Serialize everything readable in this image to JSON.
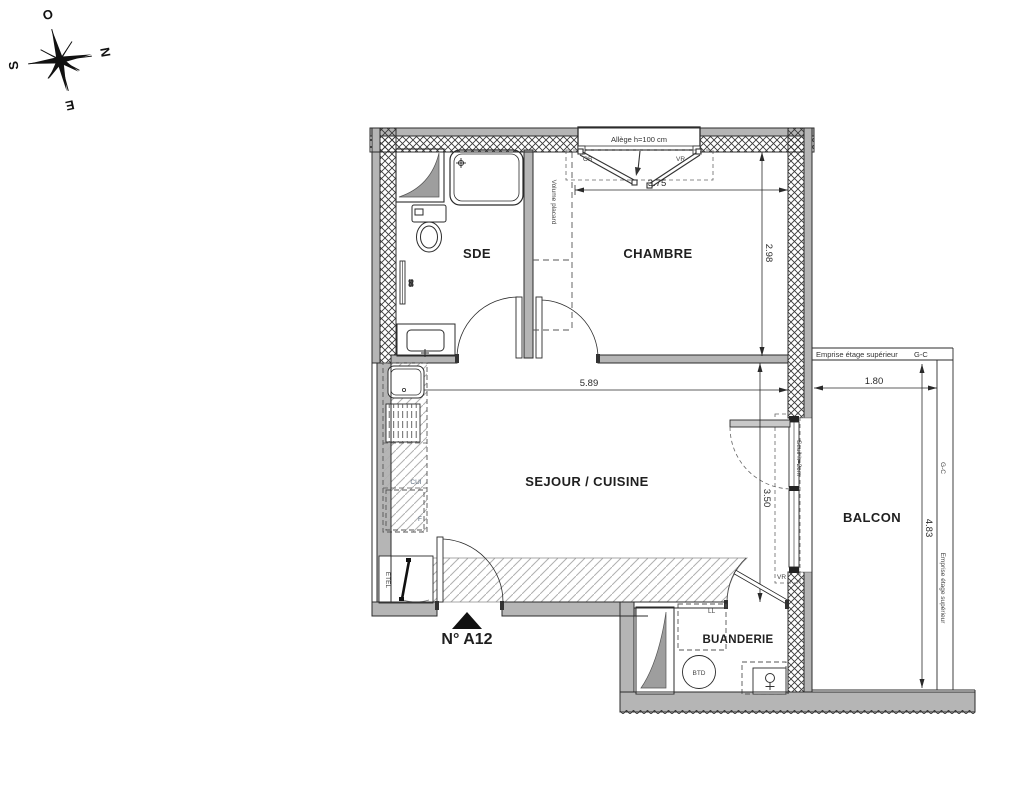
{
  "compass": {
    "west": "O",
    "north": "N",
    "south": "S",
    "east": "E"
  },
  "unit": {
    "number": "N° A12"
  },
  "rooms": {
    "sde": "SDE",
    "chambre": "CHAMBRE",
    "sejour_cuisine": "SEJOUR / CUISINE",
    "balcon": "BALCON",
    "buanderie": "BUANDERIE"
  },
  "dimensions": {
    "chambre_width": "3.75",
    "chambre_depth": "2.98",
    "sejour_width": "5.89",
    "sejour_depth": "3.50",
    "balcon_width": "1.80",
    "balcon_depth": "4.83"
  },
  "annotations": {
    "window_sill": "Allège h=100 cm",
    "ob": "OB",
    "vr_window": "VR",
    "vr_door": "VR",
    "volume_placard": "Volume placard",
    "threshold": "Seuil h=2cm",
    "emprise_top": "Emprise étage supérieur",
    "gc_top": "G-C",
    "emprise_right": "Emprise étage supérieur",
    "gc_right": "G-C",
    "towel_rail": "SS",
    "kitchen": "CUI",
    "fridge": "F",
    "etel": "ETEL",
    "washing_machine": "LL",
    "water_heater": "BTD"
  },
  "icons": {
    "entrance_marker": "filled-triangle-up",
    "buanderie_water_point": "circle-with-cross",
    "compass_rose": "eight-point-star"
  },
  "colors": {
    "wall_fill": "#b5b5b5",
    "line": "#2b2b2b",
    "hatch": "#b0b0b0",
    "kitchen_label": "#5b6b7d",
    "background": "#ffffff"
  }
}
